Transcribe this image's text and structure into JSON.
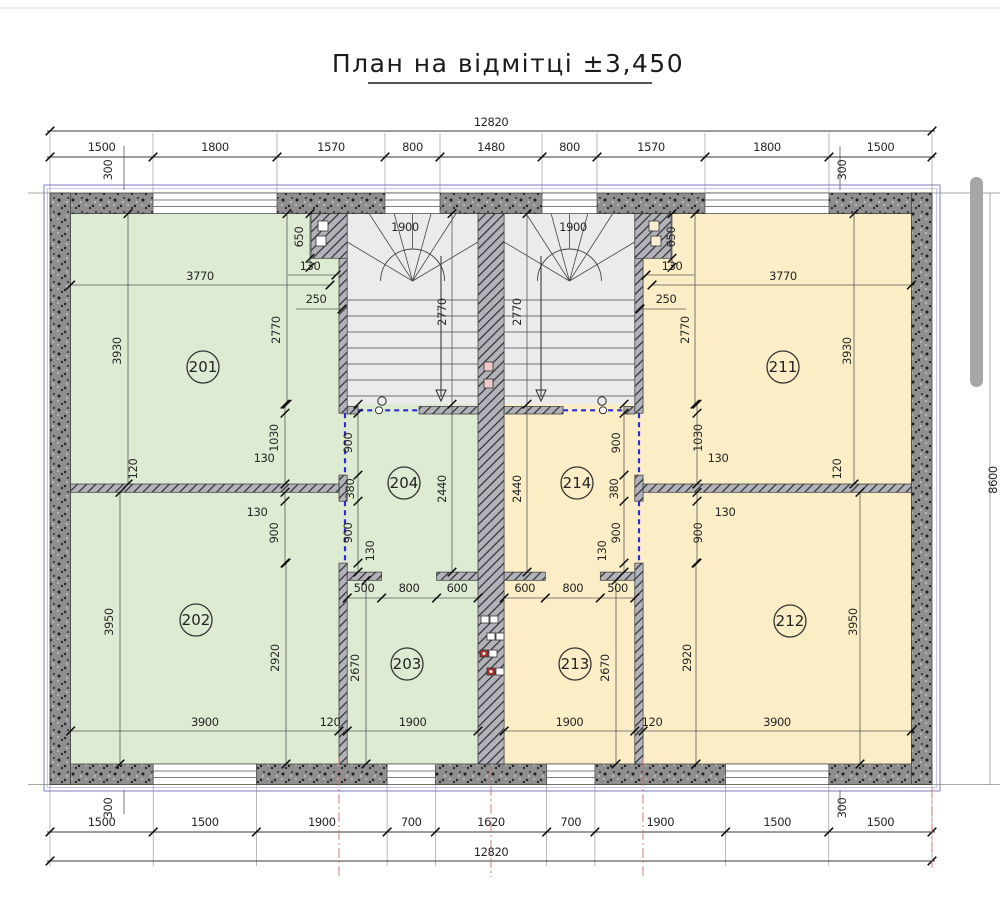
{
  "title": "План на відмітці ±3,450",
  "colors": {
    "floor_left_green": "#dcebd2",
    "floor_right_yellow": "#fbeec6",
    "stair_floor": "#ebebeb",
    "frame_blue": "#9a9ad4",
    "door_blue": "#2a2ad8",
    "centerline_red": "#cc7272",
    "wall_gray": "#8f8f8f"
  },
  "plan": {
    "overall_width": "12820",
    "overall_height": "8600",
    "wall_offset": "300",
    "top_chain": [
      "1500",
      "1800",
      "1570",
      "800",
      "1480",
      "800",
      "1570",
      "1800",
      "1500"
    ],
    "bottom_chain": [
      "1500",
      "1500",
      "1900",
      "700",
      "1620",
      "700",
      "1900",
      "1500",
      "1500"
    ],
    "rooms": {
      "201": "201",
      "202": "202",
      "203": "203",
      "204": "204",
      "211": "211",
      "212": "212",
      "213": "213",
      "214": "214"
    },
    "dims": {
      "d3770": "3770",
      "d3930": "3930",
      "d650": "650",
      "d130": "130",
      "d250": "250",
      "d2770": "2770",
      "d120": "120",
      "d1030": "1030",
      "d900": "900",
      "d380": "380",
      "d2440": "2440",
      "d500": "500",
      "d800": "800",
      "d600": "600",
      "d2670": "2670",
      "d1900": "1900",
      "d3900": "3900",
      "d3950": "3950",
      "d2920": "2920"
    }
  }
}
